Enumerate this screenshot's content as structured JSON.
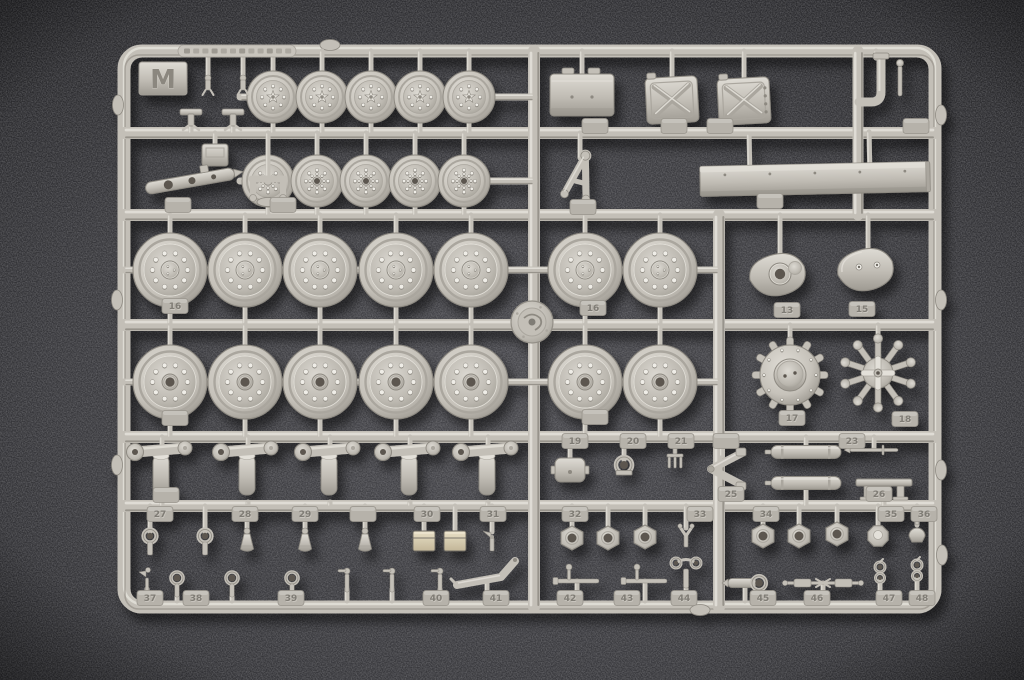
{
  "photo": {
    "subject": "plastic model kit parts sprue, runner M",
    "background": "dark grey speckled felt surface"
  },
  "sprue": {
    "letter": "M",
    "molded_plate_text": "",
    "palette": {
      "base": "#c3bfb7",
      "light": "#e3e0d9",
      "lighter": "#efede7",
      "mid": "#aaa69e",
      "dark": "#8d8981",
      "darker": "#6e6a63",
      "hole": "#5b574f",
      "tab": "#b6b2aa",
      "tabText": "#7f7b74",
      "metal": "#d8cdb2",
      "bg": "#2d2d30",
      "bgGlow": "#47474c"
    },
    "frame": {
      "x": 124,
      "y": 51,
      "w": 811,
      "h": 556,
      "rx": 18,
      "t": 13
    },
    "boss": {
      "x": 532,
      "y": 322,
      "r": 21
    },
    "letter_plate": {
      "x": 139,
      "y": 62,
      "w": 48,
      "h": 33
    },
    "text_plate": {
      "x": 178,
      "y": 45,
      "w": 118,
      "h": 12
    },
    "rails": [
      {
        "x1": 124,
        "y1": 133,
        "x2": 935,
        "y2": 133,
        "w": 12
      },
      {
        "x1": 124,
        "y1": 215,
        "x2": 935,
        "y2": 215,
        "w": 12
      },
      {
        "x1": 124,
        "y1": 325,
        "x2": 935,
        "y2": 325,
        "w": 12
      },
      {
        "x1": 124,
        "y1": 437,
        "x2": 935,
        "y2": 437,
        "w": 12
      },
      {
        "x1": 124,
        "y1": 506,
        "x2": 935,
        "y2": 506,
        "w": 12
      },
      {
        "x1": 534,
        "y1": 51,
        "x2": 534,
        "y2": 607,
        "w": 12
      },
      {
        "x1": 719,
        "y1": 215,
        "x2": 719,
        "y2": 607,
        "w": 12
      },
      {
        "x1": 858,
        "y1": 51,
        "x2": 858,
        "y2": 215,
        "w": 11
      },
      {
        "x1": 240,
        "y1": 97,
        "x2": 534,
        "y2": 97,
        "w": 7
      },
      {
        "x1": 240,
        "y1": 181,
        "x2": 534,
        "y2": 181,
        "w": 7
      },
      {
        "x1": 124,
        "y1": 270,
        "x2": 719,
        "y2": 270,
        "w": 7
      },
      {
        "x1": 124,
        "y1": 382,
        "x2": 719,
        "y2": 382,
        "w": 7
      }
    ],
    "bumps": [
      {
        "x": 941,
        "y": 115,
        "o": "v"
      },
      {
        "x": 941,
        "y": 300,
        "o": "v"
      },
      {
        "x": 941,
        "y": 470,
        "o": "v"
      },
      {
        "x": 942,
        "y": 555,
        "o": "v"
      },
      {
        "x": 118,
        "y": 105,
        "o": "v"
      },
      {
        "x": 117,
        "y": 300,
        "o": "v"
      },
      {
        "x": 117,
        "y": 465,
        "o": "v"
      },
      {
        "x": 330,
        "y": 45,
        "o": "h"
      },
      {
        "x": 700,
        "y": 610,
        "o": "h"
      }
    ],
    "parts": [
      {
        "t": "wS",
        "v": "star",
        "x": 273,
        "y": 97,
        "rt": 51,
        "rb": 133
      },
      {
        "t": "wS",
        "v": "star",
        "x": 322,
        "y": 97,
        "rt": 51,
        "rb": 133
      },
      {
        "t": "wS",
        "v": "star",
        "x": 371,
        "y": 97,
        "rt": 51,
        "rb": 133
      },
      {
        "t": "wS",
        "v": "star",
        "x": 420,
        "y": 97,
        "rt": 51,
        "rb": 133
      },
      {
        "t": "wS",
        "v": "star",
        "x": 469,
        "y": 97,
        "rt": 51,
        "rb": 133
      },
      {
        "t": "wS",
        "v": "rib",
        "x": 268,
        "y": 181,
        "rt": 133,
        "rb": 215
      },
      {
        "t": "wS",
        "v": "rib",
        "x": 317,
        "y": 181,
        "rt": 133,
        "rb": 215
      },
      {
        "t": "wS",
        "v": "rib",
        "x": 366,
        "y": 181,
        "rt": 133,
        "rb": 215
      },
      {
        "t": "wS",
        "v": "rib",
        "x": 415,
        "y": 181,
        "rt": 133,
        "rb": 215
      },
      {
        "t": "wS",
        "v": "rib",
        "x": 464,
        "y": 181,
        "rt": 133,
        "rb": 215
      },
      {
        "t": "wL",
        "v": "cap",
        "x": 170,
        "y": 270,
        "rt": 215,
        "rb": 325
      },
      {
        "t": "wL",
        "v": "cap",
        "x": 245,
        "y": 270,
        "rt": 215,
        "rb": 325
      },
      {
        "t": "wL",
        "v": "cap",
        "x": 320,
        "y": 270,
        "rt": 215,
        "rb": 325
      },
      {
        "t": "wL",
        "v": "cap",
        "x": 396,
        "y": 270,
        "rt": 215,
        "rb": 325
      },
      {
        "t": "wL",
        "v": "cap",
        "x": 471,
        "y": 270,
        "rt": 215,
        "rb": 325
      },
      {
        "t": "wL",
        "v": "cap",
        "x": 585,
        "y": 270,
        "rt": 215,
        "rb": 325
      },
      {
        "t": "wL",
        "v": "cap",
        "x": 660,
        "y": 270,
        "rt": 215,
        "rb": 325
      },
      {
        "t": "wL",
        "v": "hole",
        "x": 170,
        "y": 382,
        "rt": 325,
        "rb": 437
      },
      {
        "t": "wL",
        "v": "hole",
        "x": 245,
        "y": 382,
        "rt": 325,
        "rb": 437
      },
      {
        "t": "wL",
        "v": "hole",
        "x": 320,
        "y": 382,
        "rt": 325,
        "rb": 437
      },
      {
        "t": "wL",
        "v": "hole",
        "x": 396,
        "y": 382,
        "rt": 325,
        "rb": 437
      },
      {
        "t": "wL",
        "v": "hole",
        "x": 471,
        "y": 382,
        "rt": 325,
        "rb": 437
      },
      {
        "t": "wL",
        "v": "hole",
        "x": 585,
        "y": 382,
        "rt": 325,
        "rb": 437
      },
      {
        "t": "wL",
        "v": "hole",
        "x": 660,
        "y": 382,
        "rt": 325,
        "rb": 437
      },
      {
        "t": "td",
        "v": "boss",
        "x": 780,
        "y": 272,
        "rt": 215
      },
      {
        "t": "td",
        "v": "flat",
        "x": 868,
        "y": 267,
        "rt": 215
      },
      {
        "t": "spr",
        "v": "drum",
        "x": 790,
        "y": 375,
        "rt": 325
      },
      {
        "t": "spr",
        "v": "star",
        "x": 878,
        "y": 373,
        "rt": 325
      },
      {
        "t": "box",
        "x": 582,
        "y": 95,
        "rt": 51
      },
      {
        "t": "jc",
        "v": "plain",
        "x": 672,
        "y": 100,
        "rt": 51
      },
      {
        "t": "jc",
        "v": "dots",
        "x": 744,
        "y": 101,
        "rt": 51
      },
      {
        "t": "pipe",
        "x": 876,
        "y": 82,
        "rt": 51
      },
      {
        "t": "clampS",
        "x": 208,
        "y": 86,
        "rt": 51
      },
      {
        "t": "clampS",
        "x": 243,
        "y": 86,
        "rt": 51
      },
      {
        "t": "tclamp",
        "x": 191,
        "y": 117,
        "rb": 133
      },
      {
        "t": "tclamp",
        "x": 233,
        "y": 117,
        "rb": 133
      },
      {
        "t": "ubox",
        "x": 215,
        "y": 155,
        "rt": 133
      },
      {
        "t": "ubr",
        "x": 268,
        "y": 188,
        "rt": 133
      },
      {
        "t": "lbar",
        "x": 190,
        "y": 181
      },
      {
        "t": "afr",
        "x": 580,
        "y": 177,
        "rt": 133
      },
      {
        "t": "beam",
        "x": 815,
        "y": 179
      },
      {
        "t": "crank",
        "x": 162,
        "y": 469,
        "rt": 437,
        "rb": 506
      },
      {
        "t": "crank",
        "x": 248,
        "y": 469,
        "rt": 437,
        "rb": 506
      },
      {
        "t": "crank",
        "x": 330,
        "y": 469,
        "rt": 437,
        "rb": 506
      },
      {
        "t": "crank",
        "x": 410,
        "y": 469,
        "rt": 437,
        "rb": 506
      },
      {
        "t": "crank",
        "x": 488,
        "y": 469,
        "rt": 437,
        "rb": 506
      },
      {
        "t": "bclip",
        "x": 570,
        "y": 470,
        "rt": 445
      },
      {
        "t": "dring",
        "x": 624,
        "y": 465,
        "rt": 445
      },
      {
        "t": "tri",
        "x": 675,
        "y": 462,
        "rt": 445
      },
      {
        "t": "zig",
        "x": 722,
        "y": 469,
        "rt": 437
      },
      {
        "t": "muf",
        "x": 806,
        "y": 452,
        "rt": 437
      },
      {
        "t": "muf",
        "x": 806,
        "y": 483,
        "rb": 506
      },
      {
        "t": "trod",
        "x": 874,
        "y": 450,
        "rt": 437
      },
      {
        "t": "bench",
        "x": 884,
        "y": 486,
        "rb": 506
      },
      {
        "t": "epin",
        "x": 150,
        "y": 540,
        "rt": 506
      },
      {
        "t": "epin",
        "x": 205,
        "y": 540,
        "rt": 506
      },
      {
        "t": "cone",
        "x": 247,
        "y": 543,
        "rt": 506
      },
      {
        "t": "cone",
        "x": 305,
        "y": 543,
        "rt": 506
      },
      {
        "t": "cone",
        "x": 365,
        "y": 543,
        "rt": 506
      },
      {
        "t": "mbox",
        "x": 424,
        "y": 541,
        "rt": 506
      },
      {
        "t": "mbox",
        "x": 455,
        "y": 541,
        "rt": 506
      },
      {
        "t": "pick",
        "x": 492,
        "y": 542,
        "rt": 506
      },
      {
        "t": "hex",
        "x": 572,
        "y": 538,
        "rt": 506
      },
      {
        "t": "hex",
        "x": 608,
        "y": 538,
        "rt": 506
      },
      {
        "t": "hex",
        "x": 645,
        "y": 537,
        "rt": 506
      },
      {
        "t": "fork",
        "x": 686,
        "y": 536,
        "rt": 506
      },
      {
        "t": "hex",
        "x": 763,
        "y": 536,
        "rt": 506
      },
      {
        "t": "hex",
        "x": 799,
        "y": 536,
        "rt": 506
      },
      {
        "t": "hex",
        "x": 837,
        "y": 534,
        "rt": 506
      },
      {
        "t": "oct",
        "x": 878,
        "y": 536,
        "rt": 506
      },
      {
        "t": "acorn",
        "x": 917,
        "y": 533,
        "rt": 506
      },
      {
        "t": "bird",
        "x": 147,
        "y": 581,
        "rb": 601
      },
      {
        "t": "eyelet",
        "x": 177,
        "y": 581,
        "rb": 601
      },
      {
        "t": "eyelet",
        "x": 232,
        "y": 581,
        "rb": 601
      },
      {
        "t": "eyelet",
        "x": 292,
        "y": 581,
        "rb": 601
      },
      {
        "t": "valve",
        "x": 347,
        "y": 579,
        "rb": 601
      },
      {
        "t": "valve",
        "x": 392,
        "y": 579,
        "rb": 601
      },
      {
        "t": "valve",
        "x": 440,
        "y": 579,
        "rb": 601
      },
      {
        "t": "brL",
        "x": 487,
        "y": 571,
        "rb": 601
      },
      {
        "t": "rodT",
        "x": 577,
        "y": 581,
        "rb": 601
      },
      {
        "t": "rodT",
        "x": 645,
        "y": 581,
        "rb": 601
      },
      {
        "t": "cal",
        "x": 686,
        "y": 575,
        "rb": 601
      },
      {
        "t": "epipe",
        "x": 745,
        "y": 583,
        "rb": 601
      },
      {
        "t": "tow",
        "x": 823,
        "y": 583,
        "rb": 601
      },
      {
        "t": "clink",
        "x": 880,
        "y": 576,
        "rb": 601
      },
      {
        "t": "clink",
        "x": 917,
        "y": 574,
        "rb": 601
      }
    ],
    "tabs": [
      {
        "x": 595,
        "y": 126,
        "l": ""
      },
      {
        "x": 674,
        "y": 126,
        "l": ""
      },
      {
        "x": 720,
        "y": 126,
        "l": ""
      },
      {
        "x": 916,
        "y": 126,
        "l": ""
      },
      {
        "x": 178,
        "y": 205,
        "l": ""
      },
      {
        "x": 283,
        "y": 205,
        "l": ""
      },
      {
        "x": 583,
        "y": 207,
        "l": ""
      },
      {
        "x": 770,
        "y": 201,
        "l": ""
      },
      {
        "x": 175,
        "y": 306,
        "l": "16"
      },
      {
        "x": 593,
        "y": 308,
        "l": "16"
      },
      {
        "x": 787,
        "y": 310,
        "l": "13"
      },
      {
        "x": 862,
        "y": 309,
        "l": "15"
      },
      {
        "x": 175,
        "y": 418,
        "l": ""
      },
      {
        "x": 595,
        "y": 417,
        "l": ""
      },
      {
        "x": 792,
        "y": 418,
        "l": "17"
      },
      {
        "x": 905,
        "y": 419,
        "l": "18"
      },
      {
        "x": 166,
        "y": 495,
        "l": ""
      },
      {
        "x": 575,
        "y": 441,
        "l": "19"
      },
      {
        "x": 633,
        "y": 441,
        "l": "20"
      },
      {
        "x": 681,
        "y": 441,
        "l": "21"
      },
      {
        "x": 726,
        "y": 441,
        "l": ""
      },
      {
        "x": 852,
        "y": 441,
        "l": "23"
      },
      {
        "x": 731,
        "y": 494,
        "l": "25"
      },
      {
        "x": 879,
        "y": 494,
        "l": "26"
      },
      {
        "x": 160,
        "y": 514,
        "l": "27"
      },
      {
        "x": 245,
        "y": 514,
        "l": "28"
      },
      {
        "x": 305,
        "y": 514,
        "l": "29"
      },
      {
        "x": 363,
        "y": 514,
        "l": ""
      },
      {
        "x": 427,
        "y": 514,
        "l": "30"
      },
      {
        "x": 493,
        "y": 514,
        "l": "31"
      },
      {
        "x": 575,
        "y": 514,
        "l": "32"
      },
      {
        "x": 700,
        "y": 514,
        "l": "33"
      },
      {
        "x": 766,
        "y": 514,
        "l": "34"
      },
      {
        "x": 891,
        "y": 514,
        "l": "35"
      },
      {
        "x": 924,
        "y": 514,
        "l": "36"
      },
      {
        "x": 150,
        "y": 598,
        "l": "37"
      },
      {
        "x": 196,
        "y": 598,
        "l": "38"
      },
      {
        "x": 291,
        "y": 598,
        "l": "39"
      },
      {
        "x": 436,
        "y": 598,
        "l": "40"
      },
      {
        "x": 496,
        "y": 598,
        "l": "41"
      },
      {
        "x": 570,
        "y": 598,
        "l": "42"
      },
      {
        "x": 627,
        "y": 598,
        "l": "43"
      },
      {
        "x": 684,
        "y": 598,
        "l": "44"
      },
      {
        "x": 763,
        "y": 598,
        "l": "45"
      },
      {
        "x": 817,
        "y": 598,
        "l": "46"
      },
      {
        "x": 889,
        "y": 598,
        "l": "47"
      },
      {
        "x": 922,
        "y": 598,
        "l": "48"
      }
    ]
  }
}
